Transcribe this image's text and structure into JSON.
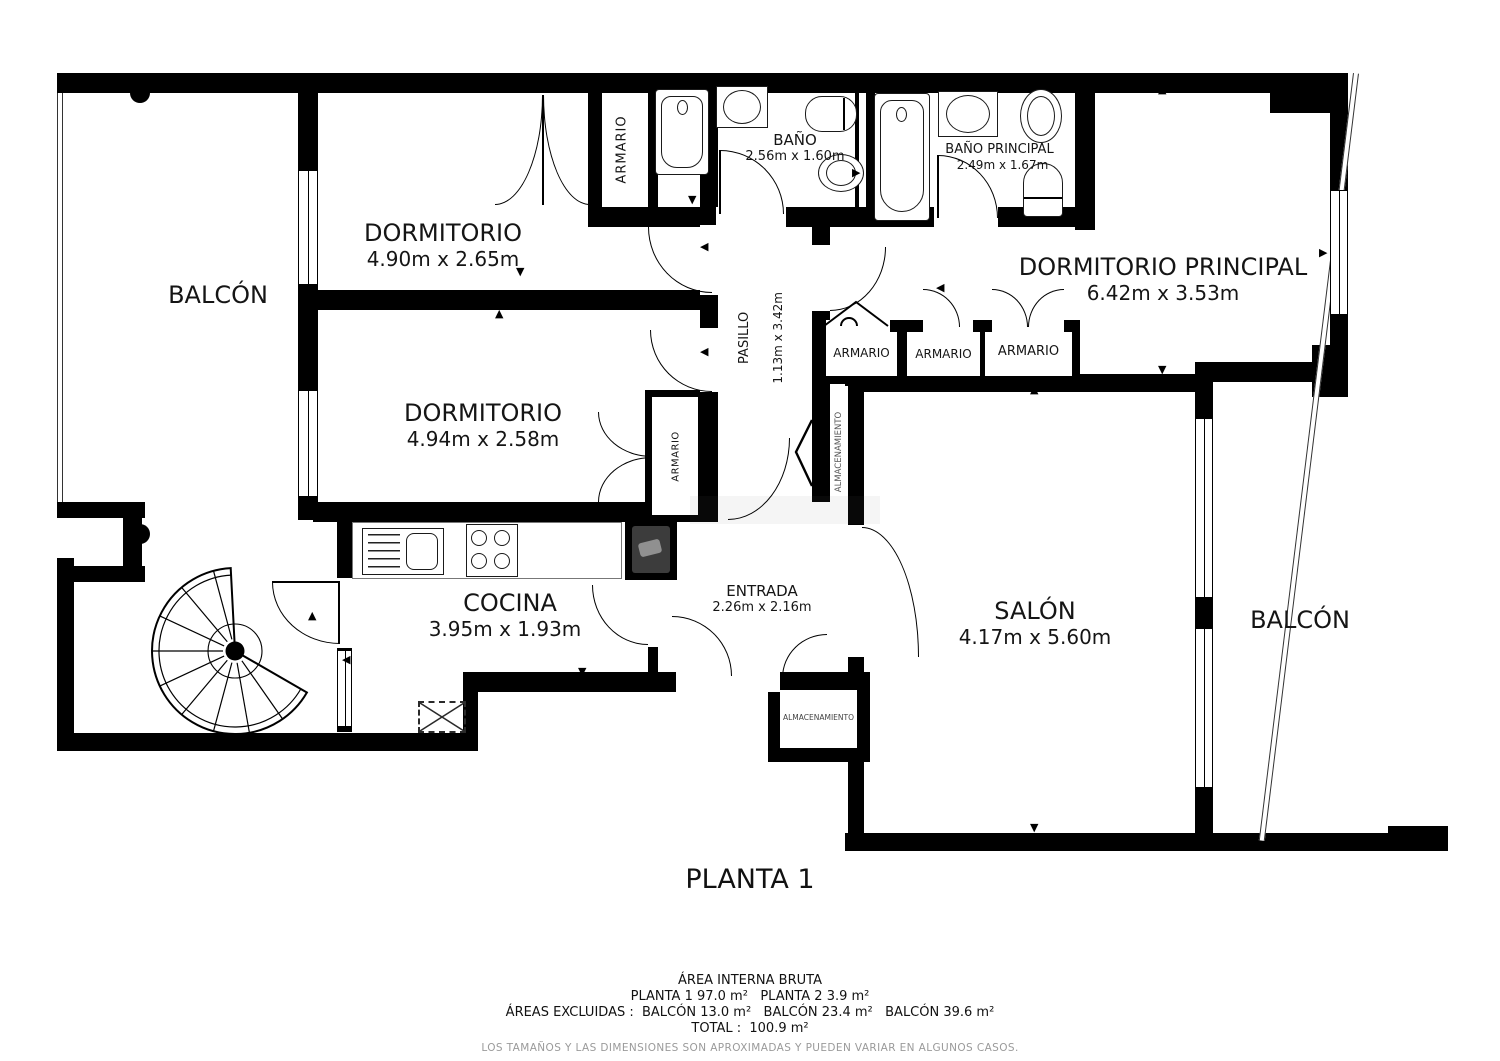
{
  "plan": {
    "floor_label": "PLANTA 1",
    "rooms": {
      "balcon_left": {
        "name": "BALCÓN"
      },
      "dormitorio1": {
        "name": "DORMITORIO",
        "dims": "4.90m x 2.65m"
      },
      "armario_top": {
        "name": "ARMARIO"
      },
      "bano": {
        "name": "BAÑO",
        "dims": "2.56m x 1.60m"
      },
      "bano_principal": {
        "name": "BAÑO PRINCIPAL",
        "dims": "2.49m x 1.67m"
      },
      "dormitorio_principal": {
        "name": "DORMITORIO PRINCIPAL",
        "dims": "6.42m x 3.53m"
      },
      "pasillo": {
        "name": "PASILLO",
        "dims": "1.13m x 3.42m"
      },
      "armario_1": {
        "name": "ARMARIO"
      },
      "armario_2": {
        "name": "ARMARIO"
      },
      "armario_3": {
        "name": "ARMARIO"
      },
      "dormitorio2": {
        "name": "DORMITORIO",
        "dims": "4.94m x 2.58m"
      },
      "armario_mid": {
        "name": "ARMARIO"
      },
      "almacenamiento_strip": {
        "name": "ALMACENAMIENTO"
      },
      "salon": {
        "name": "SALÓN",
        "dims": "4.17m x 5.60m"
      },
      "balcon_right": {
        "name": "BALCÓN"
      },
      "cocina": {
        "name": "COCINA",
        "dims": "3.95m x 1.93m"
      },
      "entrada": {
        "name": "ENTRADA",
        "dims": "2.26m x 2.16m"
      },
      "almacenamiento_box": {
        "name": "ALMACENAMIENTO"
      }
    },
    "footer": {
      "line1": "ÁREA INTERNA BRUTA",
      "line2": "PLANTA 1 97.0 m²   PLANTA 2 3.9 m²",
      "line3": "ÁREAS EXCLUIDAS :  BALCÓN 13.0 m²   BALCÓN 23.4 m²   BALCÓN 39.6 m²",
      "line4": "TOTAL :  100.9 m²",
      "disclaimer": "LOS TAMAÑOS Y LAS DIMENSIONES SON APROXIMADAS Y PUEDEN VARIAR EN ALGUNOS CASOS."
    },
    "icons": {
      "up": "▲",
      "down": "▼",
      "left": "◀",
      "right": "▶"
    },
    "colors": {
      "wall": "#000000",
      "background": "#ffffff",
      "disclaimer_text": "#9a9a9a"
    }
  }
}
